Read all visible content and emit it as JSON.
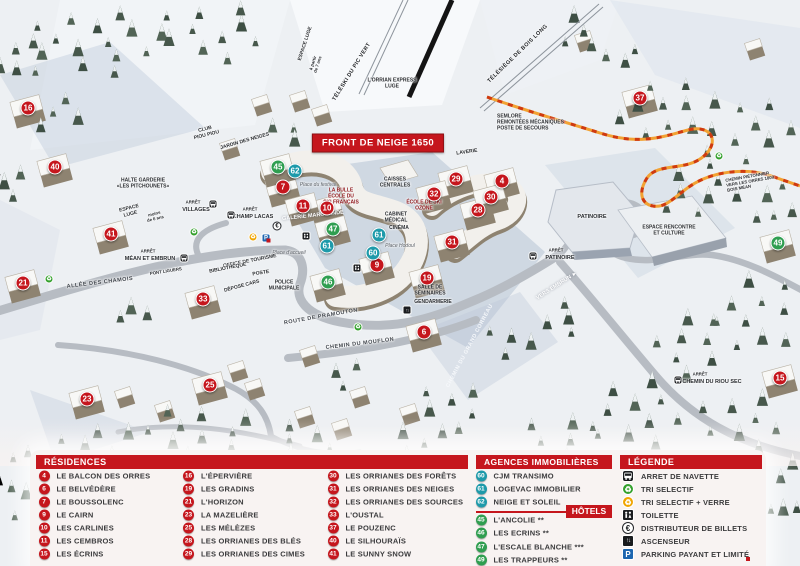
{
  "map": {
    "banner": "FRONT DE NEIGE 1650",
    "markers": [
      {
        "num": "4",
        "type": "residence",
        "x": 502,
        "y": 181
      },
      {
        "num": "6",
        "type": "residence",
        "x": 424,
        "y": 332
      },
      {
        "num": "7",
        "type": "residence",
        "x": 283,
        "y": 187
      },
      {
        "num": "9",
        "type": "residence",
        "x": 377,
        "y": 265
      },
      {
        "num": "10",
        "type": "residence",
        "x": 327,
        "y": 208
      },
      {
        "num": "11",
        "type": "residence",
        "x": 303,
        "y": 206
      },
      {
        "num": "15",
        "type": "residence",
        "x": 780,
        "y": 378
      },
      {
        "num": "16",
        "type": "residence",
        "x": 28,
        "y": 108
      },
      {
        "num": "19",
        "type": "residence",
        "x": 427,
        "y": 278
      },
      {
        "num": "21",
        "type": "residence",
        "x": 23,
        "y": 283
      },
      {
        "num": "23",
        "type": "residence",
        "x": 87,
        "y": 399
      },
      {
        "num": "25",
        "type": "residence",
        "x": 210,
        "y": 385
      },
      {
        "num": "28",
        "type": "residence",
        "x": 478,
        "y": 210
      },
      {
        "num": "29",
        "type": "residence",
        "x": 456,
        "y": 179
      },
      {
        "num": "30",
        "type": "residence",
        "x": 491,
        "y": 197
      },
      {
        "num": "31",
        "type": "residence",
        "x": 452,
        "y": 242
      },
      {
        "num": "32",
        "type": "residence",
        "x": 434,
        "y": 194
      },
      {
        "num": "33",
        "type": "residence",
        "x": 203,
        "y": 299
      },
      {
        "num": "37",
        "type": "residence",
        "x": 640,
        "y": 98
      },
      {
        "num": "40",
        "type": "residence",
        "x": 55,
        "y": 167
      },
      {
        "num": "41",
        "type": "residence",
        "x": 111,
        "y": 234
      },
      {
        "num": "45",
        "type": "hotel",
        "x": 278,
        "y": 167
      },
      {
        "num": "46",
        "type": "hotel",
        "x": 328,
        "y": 282
      },
      {
        "num": "47",
        "type": "hotel",
        "x": 333,
        "y": 229
      },
      {
        "num": "49",
        "type": "hotel",
        "x": 778,
        "y": 243
      },
      {
        "num": "60",
        "type": "agence",
        "x": 373,
        "y": 253
      },
      {
        "num": "61",
        "type": "agence",
        "x": 327,
        "y": 246
      },
      {
        "num": "61",
        "type": "agence",
        "x": 379,
        "y": 235
      },
      {
        "num": "62",
        "type": "agence",
        "x": 295,
        "y": 171
      }
    ],
    "labels": [
      {
        "t": "ESPACE LUGE",
        "x": 306,
        "y": 44,
        "rot": -72,
        "cls": "sm"
      },
      {
        "t": "à partir\nde 7 ans",
        "x": 316,
        "y": 64,
        "rot": -72,
        "cls": "xxs"
      },
      {
        "t": "TÉLÉSKI DU PIC VERT",
        "x": 352,
        "y": 72,
        "rot": -58,
        "cls": "lift"
      },
      {
        "t": "L'ORRIAN EXPRESS\nLUGE",
        "x": 392,
        "y": 84,
        "cls": "sm"
      },
      {
        "t": "TÉLÉSIÈGE DE BOIS LONG",
        "x": 518,
        "y": 54,
        "rot": -44,
        "cls": "lift"
      },
      {
        "t": "SEMLORE\nREMONTÉES MÉCANIQUES\nPOSTE DE SECOURS",
        "x": 497,
        "y": 123,
        "cls": "sm",
        "align": "left"
      },
      {
        "t": "CLUB\nPIOU PIOU",
        "x": 206,
        "y": 133,
        "rot": -14,
        "cls": "sm"
      },
      {
        "t": "JARDIN DES NEIGES",
        "x": 245,
        "y": 142,
        "rot": -16,
        "cls": "sm"
      },
      {
        "t": "HALTE GARDERIE\n«LES PITCHOUNETS»",
        "x": 143,
        "y": 184,
        "cls": "sm"
      },
      {
        "t": "ESPACE\nLUGE",
        "x": 130,
        "y": 212,
        "rot": -14,
        "cls": "sm"
      },
      {
        "t": "moins\nde 6 ans",
        "x": 155,
        "y": 217,
        "rot": -14,
        "cls": "xxs"
      },
      {
        "t": "ARRÊT",
        "x": 193,
        "y": 203,
        "cls": "xxs"
      },
      {
        "t": "VILLAGES",
        "x": 196,
        "y": 210,
        "cls": "md"
      },
      {
        "t": "ARRÊT",
        "x": 250,
        "y": 210,
        "cls": "xxs"
      },
      {
        "t": "CHAMP LACAS",
        "x": 253,
        "y": 217,
        "cls": "md"
      },
      {
        "t": "ARRÊT",
        "x": 148,
        "y": 252,
        "cls": "xxs"
      },
      {
        "t": "MÉAN ET EMBRUN",
        "x": 150,
        "y": 259,
        "cls": "md"
      },
      {
        "t": "PONT LIGUERS",
        "x": 166,
        "y": 272,
        "rot": -9,
        "cls": "xxs"
      },
      {
        "t": "ALLÉE DES CHAMOIS",
        "x": 100,
        "y": 283,
        "rot": -7,
        "cls": "road"
      },
      {
        "t": "LAVERIE",
        "x": 467,
        "y": 153,
        "rot": -8,
        "cls": "sm"
      },
      {
        "t": "CAISSES\nCENTRALES",
        "x": 395,
        "y": 183,
        "cls": "sm"
      },
      {
        "t": "LA BULLE\nÉCOLE DU\nSKI FRANÇAIS",
        "x": 341,
        "y": 197,
        "cls": "red-label"
      },
      {
        "t": "ÉCOLE DE SKI\nOZONE",
        "x": 424,
        "y": 206,
        "cls": "red-label"
      },
      {
        "t": "GALERIE MARCHANDE",
        "x": 313,
        "y": 216,
        "rot": -6,
        "cls": "white-label"
      },
      {
        "t": "CABINET\nMÉDICAL",
        "x": 396,
        "y": 218,
        "cls": "sm"
      },
      {
        "t": "CINÉMA",
        "x": 399,
        "y": 229,
        "cls": "sm"
      },
      {
        "t": "Place du festival",
        "x": 318,
        "y": 186,
        "cls": "place"
      },
      {
        "t": "Place d'accueil",
        "x": 289,
        "y": 254,
        "cls": "place"
      },
      {
        "t": "Place Hodoul",
        "x": 400,
        "y": 247,
        "cls": "place"
      },
      {
        "t": "OFFICE DE TOURISME",
        "x": 250,
        "y": 262,
        "rot": -11,
        "cls": "sm"
      },
      {
        "t": "BIBLIOTHÈQUE",
        "x": 228,
        "y": 269,
        "rot": -11,
        "cls": "sm"
      },
      {
        "t": "POSTE",
        "x": 261,
        "y": 274,
        "rot": -9,
        "cls": "sm"
      },
      {
        "t": "DÉPOSE CARS",
        "x": 242,
        "y": 287,
        "rot": -15,
        "cls": "sm"
      },
      {
        "t": "POLICE\nMUNICIPALE",
        "x": 284,
        "y": 286,
        "cls": "sm"
      },
      {
        "t": "ROUTE DE PRAMOUTON",
        "x": 321,
        "y": 317,
        "rot": -10,
        "cls": "road"
      },
      {
        "t": "CHEMIN DU MOUFLON",
        "x": 360,
        "y": 344,
        "rot": -7,
        "cls": "road"
      },
      {
        "t": "CHEMIN DU GRAND CORREAU",
        "x": 470,
        "y": 346,
        "rot": -62,
        "cls": "road-white"
      },
      {
        "t": "VERS EMBRUN ►",
        "x": 557,
        "y": 286,
        "rot": -33,
        "cls": "white-label"
      },
      {
        "t": "SALLE DE\nSÉMINAIRES",
        "x": 430,
        "y": 291,
        "cls": "sm"
      },
      {
        "t": "GENDARMERIE",
        "x": 433,
        "y": 303,
        "cls": "sm"
      },
      {
        "t": "ARRÊT",
        "x": 556,
        "y": 251,
        "cls": "xxs"
      },
      {
        "t": "PATINOIRE",
        "x": 560,
        "y": 258,
        "cls": "md"
      },
      {
        "t": "PATINOIRE",
        "x": 592,
        "y": 217,
        "cls": "md"
      },
      {
        "t": "ESPACE RENCONTRE\nET CULTURE",
        "x": 669,
        "y": 231,
        "cls": "sm"
      },
      {
        "t": "CHEMIN PIÉTONNIER\nVERS LES ORRES 1800\nBOIS MÉAN",
        "x": 726,
        "y": 182,
        "rot": -10,
        "cls": "xxs",
        "align": "left"
      },
      {
        "t": "ARRÊT",
        "x": 700,
        "y": 375,
        "cls": "xxs"
      },
      {
        "t": "CHEMIN DU RIOU SEC",
        "x": 712,
        "y": 382,
        "cls": "md"
      }
    ],
    "icons": [
      {
        "type": "bus-icon",
        "x": 213,
        "y": 204
      },
      {
        "type": "bus-icon",
        "x": 231,
        "y": 215
      },
      {
        "type": "bus-icon",
        "x": 184,
        "y": 258
      },
      {
        "type": "bus-icon",
        "x": 533,
        "y": 256
      },
      {
        "type": "bus-icon",
        "x": 678,
        "y": 380
      },
      {
        "type": "recycle-green-icon",
        "x": 194,
        "y": 232
      },
      {
        "type": "recycle-green-icon",
        "x": 49,
        "y": 279
      },
      {
        "type": "recycle-green-icon",
        "x": 358,
        "y": 327
      },
      {
        "type": "recycle-green-icon",
        "x": 719,
        "y": 156
      },
      {
        "type": "recycle-yellow-icon",
        "x": 253,
        "y": 237
      },
      {
        "type": "parking-icon",
        "x": 266,
        "y": 238
      },
      {
        "type": "euro-icon",
        "x": 277,
        "y": 226
      },
      {
        "type": "toilet-icon",
        "x": 306,
        "y": 236
      },
      {
        "type": "toilet-icon",
        "x": 357,
        "y": 268
      },
      {
        "type": "elevator-icon",
        "x": 407,
        "y": 310
      }
    ]
  },
  "panel": {
    "residences": {
      "title": "RÉSIDENCES",
      "items": [
        {
          "num": "4",
          "label": "LE BALCON DES ORRES"
        },
        {
          "num": "6",
          "label": "LE BELVÉDÈRE"
        },
        {
          "num": "7",
          "label": "LE BOUSSOLENC"
        },
        {
          "num": "9",
          "label": "LE CAIRN"
        },
        {
          "num": "10",
          "label": "LES CARLINES"
        },
        {
          "num": "11",
          "label": "LES CEMBROS"
        },
        {
          "num": "15",
          "label": "LES ÉCRINS"
        },
        {
          "num": "16",
          "label": "L'ÉPERVIÈRE"
        },
        {
          "num": "19",
          "label": "LES GRADINS"
        },
        {
          "num": "21",
          "label": "L'HORIZON"
        },
        {
          "num": "23",
          "label": "LA MAZELIÈRE"
        },
        {
          "num": "25",
          "label": "LES MÉLÈZES"
        },
        {
          "num": "28",
          "label": "LES ORRIANES DES BLÉS"
        },
        {
          "num": "29",
          "label": "LES ORRIANES DES CIMES"
        },
        {
          "num": "30",
          "label": "LES ORRIANES DES FORÊTS"
        },
        {
          "num": "31",
          "label": "LES ORRIANES DES NEIGES"
        },
        {
          "num": "32",
          "label": "LES ORRIANES DES SOURCES"
        },
        {
          "num": "33",
          "label": "L'OUSTAL"
        },
        {
          "num": "37",
          "label": "LE POUZENC"
        },
        {
          "num": "40",
          "label": "LE SILHOURAÏS"
        },
        {
          "num": "41",
          "label": "LE SUNNY SNOW"
        }
      ]
    },
    "agences": {
      "title": "AGENCES IMMOBILIÈRES",
      "items": [
        {
          "num": "60",
          "label": "CJM TRANSIMO"
        },
        {
          "num": "61",
          "label": "LOGEVAC IMMOBILIER"
        },
        {
          "num": "62",
          "label": "NEIGE ET SOLEIL"
        }
      ]
    },
    "hotels": {
      "title": "HÔTELS",
      "items": [
        {
          "num": "45",
          "label": "L'ANCOLIE **"
        },
        {
          "num": "46",
          "label": "LES ECRINS **"
        },
        {
          "num": "47",
          "label": "L'ESCALE BLANCHE ***"
        },
        {
          "num": "49",
          "label": "LES TRAPPEURS **"
        }
      ]
    },
    "legende": {
      "title": "LÉGENDE",
      "items": [
        {
          "icon": "bus-icon",
          "label": "ARRET DE NAVETTE"
        },
        {
          "icon": "recycle-green-icon",
          "label": "TRI SELECTIF"
        },
        {
          "icon": "recycle-yellow-icon",
          "label": "TRI SELECTIF + VERRE"
        },
        {
          "icon": "toilet-icon",
          "label": "TOILETTE"
        },
        {
          "icon": "euro-icon",
          "label": "DISTRIBUTEUR DE BILLETS"
        },
        {
          "icon": "elevator-icon",
          "label": "ASCENSEUR"
        },
        {
          "icon": "parking-icon",
          "label": "PARKING PAYANT ET LIMITÉ"
        }
      ]
    }
  },
  "colors": {
    "residence": "#c5161d",
    "hotel": "#2f9e50",
    "agence": "#1e9aaa",
    "header_red": "#c5161d",
    "parking_blue": "#1d66b0",
    "recycle_green": "#33a02c",
    "recycle_yellow": "#f0a500",
    "trail_orange": "#f2a233",
    "trail_red": "#cf3a10"
  }
}
